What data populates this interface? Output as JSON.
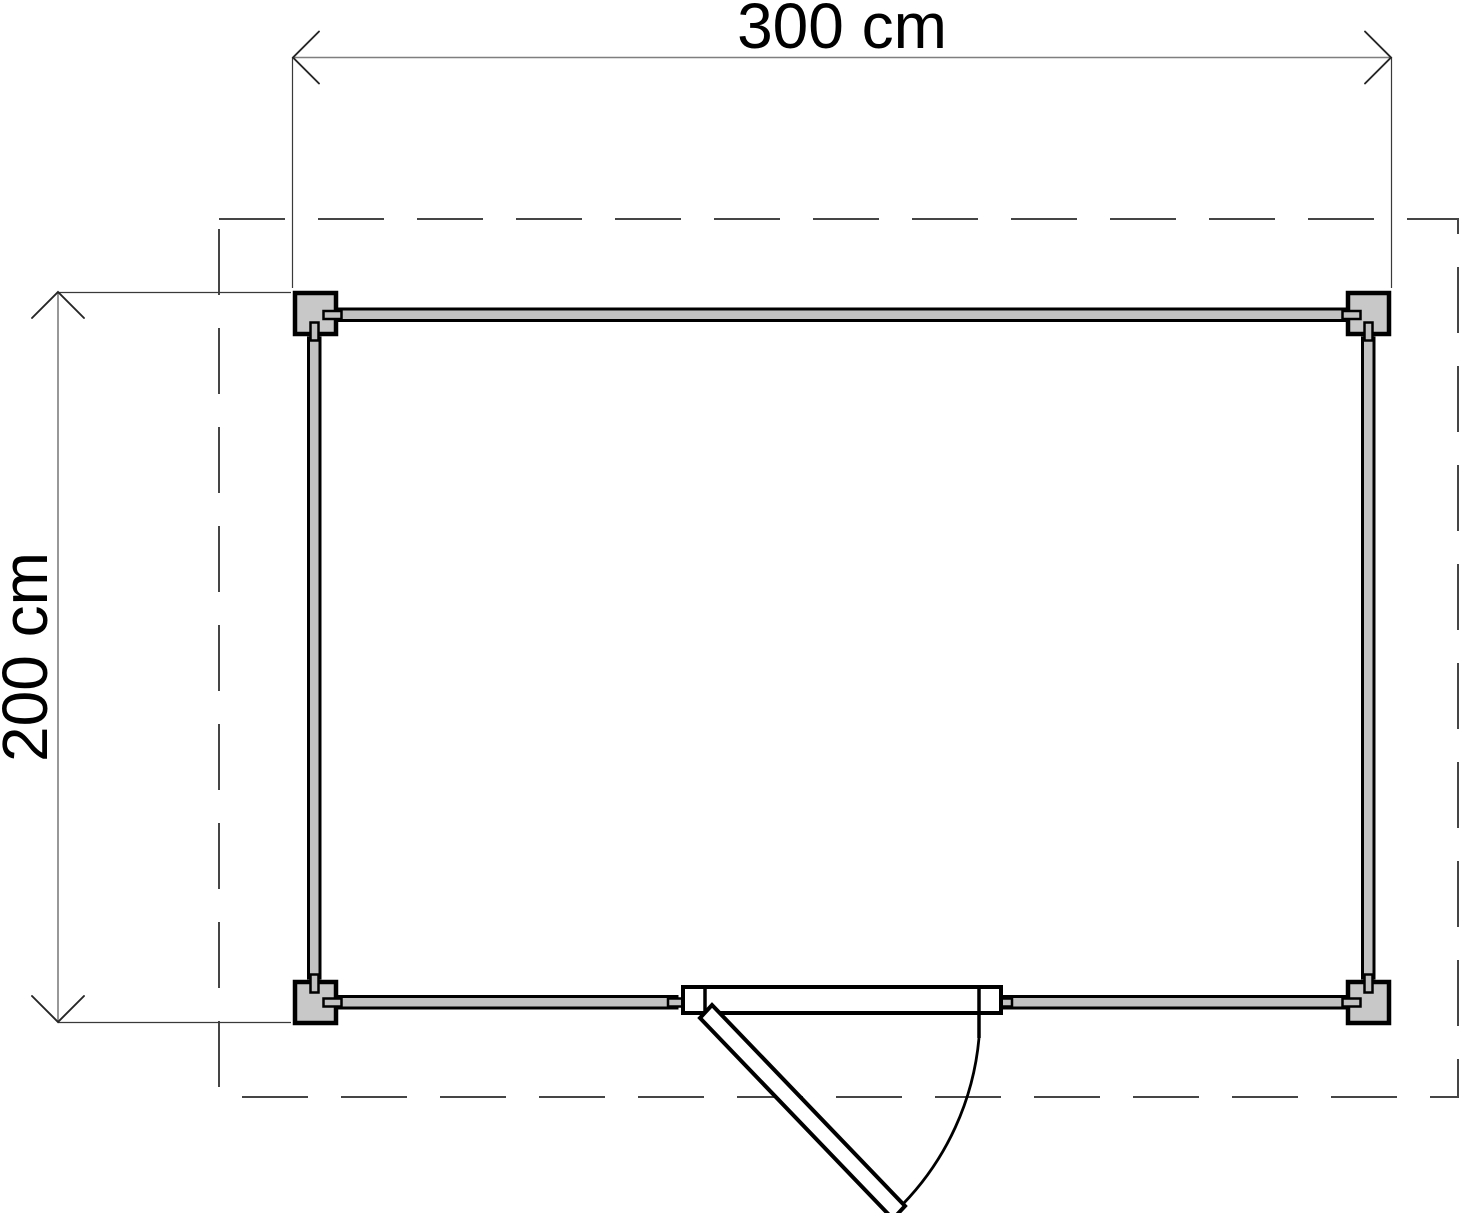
{
  "plan": {
    "kind": "floor-plan-top-view",
    "width_dimension": {
      "label": "300 cm",
      "value_cm": 300
    },
    "depth_dimension": {
      "label": "200 cm",
      "value_cm": 200
    },
    "colors": {
      "background": "#ffffff",
      "outline": "#000000",
      "wall_fill": "#c2c2c2",
      "post_fill": "#c8c8c8",
      "door_fill": "#ffffff",
      "overhang_dash": "#454545",
      "dimension_line": "#7f7f7f",
      "text": "#000000"
    }
  }
}
